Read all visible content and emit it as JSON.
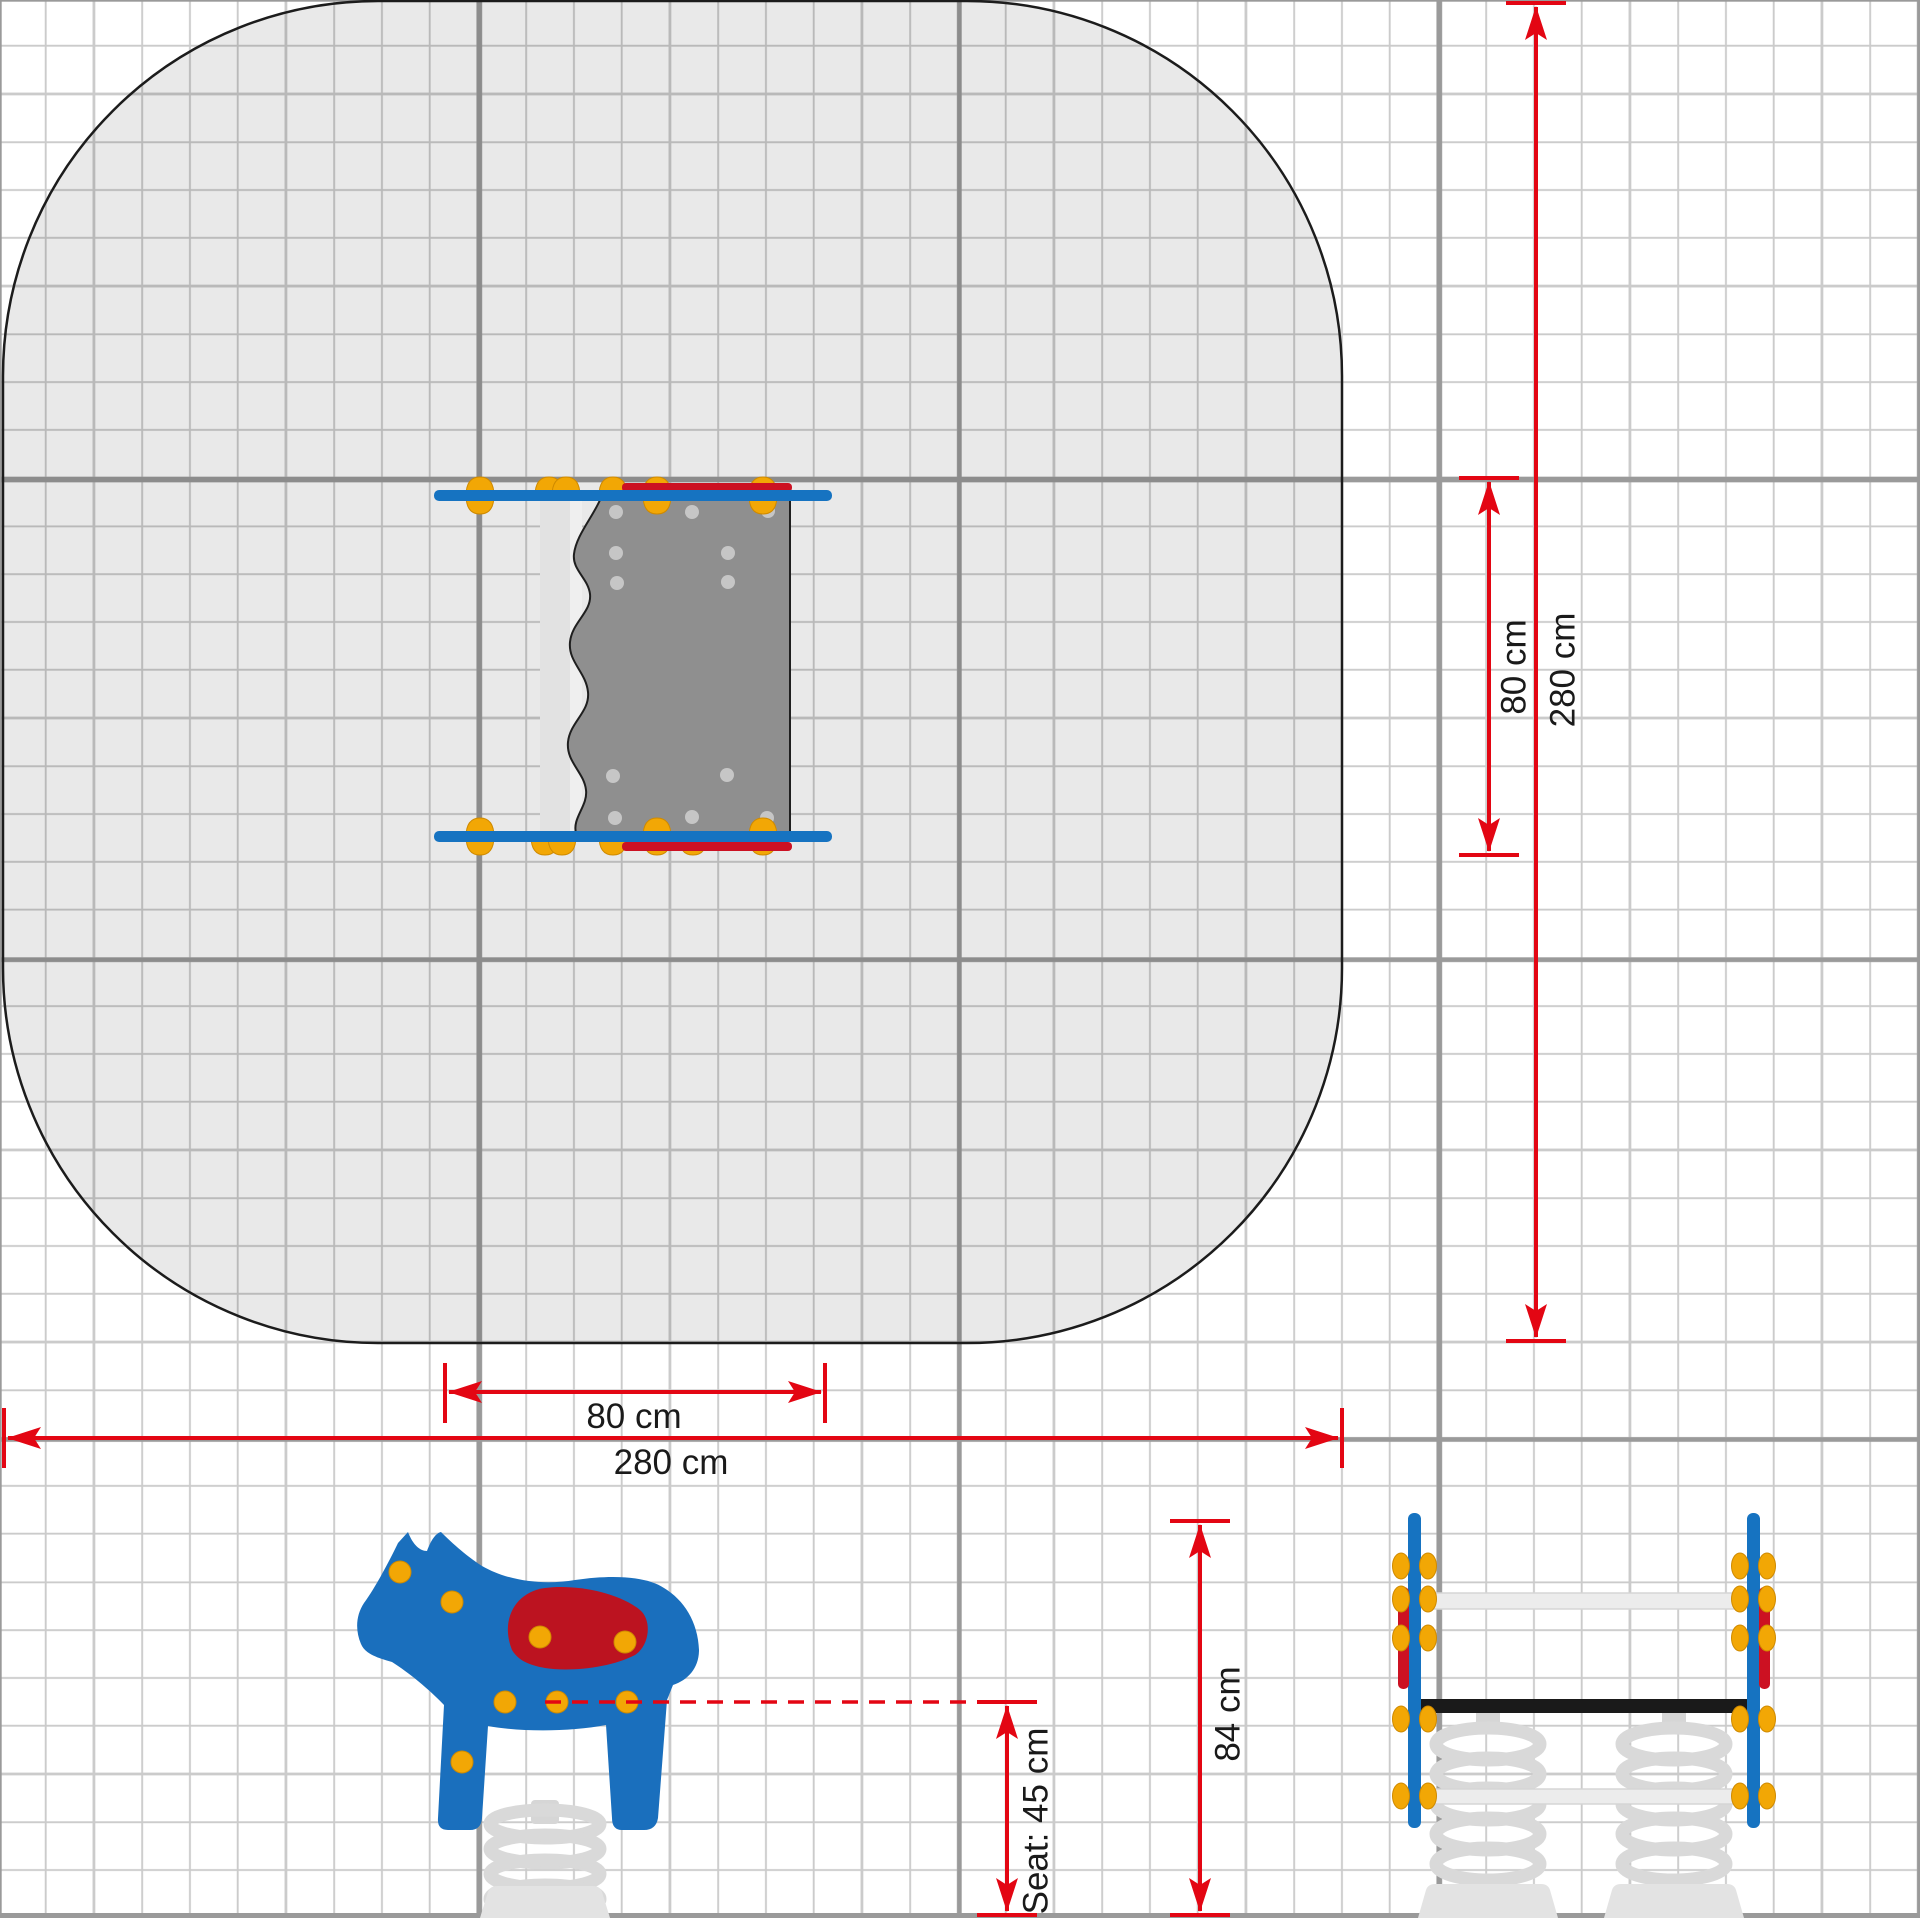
{
  "dims": {
    "item_width": "80 cm",
    "zone_width": "280 cm",
    "item_depth": "80 cm",
    "zone_depth": "280 cm",
    "total_height": "84 cm",
    "seat_height": "Seat: 45 cm"
  },
  "colors": {
    "dimension_red": "#e30613",
    "equipment_blue": "#1673c1",
    "horse_blue": "#1a6fbd",
    "saddle_red": "#bc1320",
    "knob_yellow": "#f2a705",
    "top_view_gray": "#8f8f8f",
    "zone_outline": "#1c1c1c",
    "grid_minor": "#cbcbcb",
    "grid_major": "#9a9a9a",
    "spring_gray": "#d9d9d9"
  }
}
